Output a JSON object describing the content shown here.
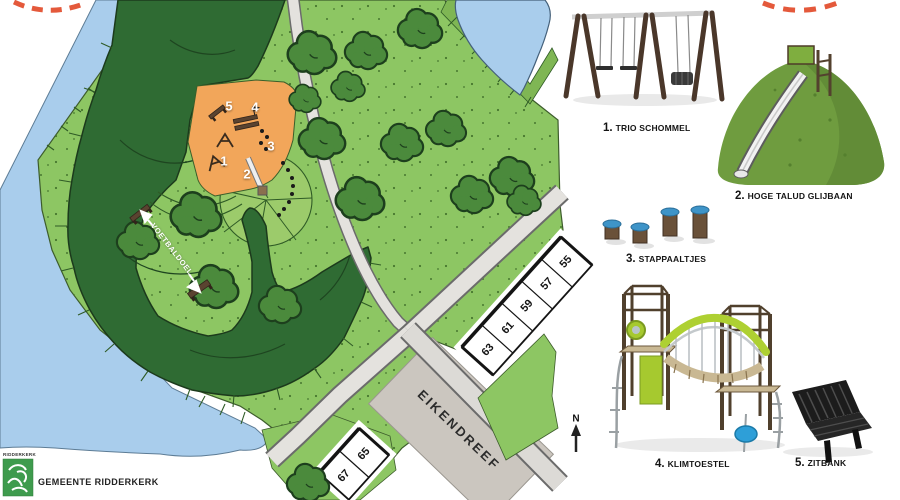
{
  "map": {
    "markers": [
      "1",
      "2",
      "3",
      "4",
      "5"
    ],
    "voetbaldoel": "VOETBALDOEL",
    "street": "EIKENDREEF",
    "houses_row1": [
      "63",
      "61",
      "59",
      "57",
      "55"
    ],
    "houses_row2": [
      "67",
      "65"
    ],
    "north": "N"
  },
  "legend": {
    "items": [
      {
        "num": "1.",
        "label": "TRIO SCHOMMEL"
      },
      {
        "num": "2.",
        "label": "HOGE TALUD GLIJBAAN"
      },
      {
        "num": "3.",
        "label": "STAPPAALTJES"
      },
      {
        "num": "4.",
        "label": "KLIMTOESTEL"
      },
      {
        "num": "5.",
        "label": "ZITBANK"
      }
    ]
  },
  "footer": {
    "logo_small": "RIDDERKERK",
    "municipality": "GEMEENTE RIDDERKERK"
  },
  "colors": {
    "water": "#a9cdec",
    "grass": "#8dc663",
    "hedge": "#2f6b33",
    "tree": "#4b8a3c",
    "play_area": "#f2a65a",
    "road": "#e4e2de",
    "street_block": "#cbc6bf",
    "lime_equipment": "#aed032",
    "post_top_blue": "#3e94c8",
    "dash_marker": "#e4593b",
    "logo_green": "#3e9b4d"
  }
}
